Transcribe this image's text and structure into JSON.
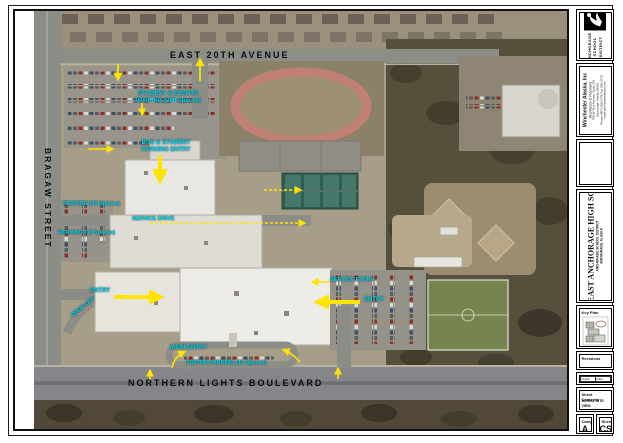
{
  "map": {
    "streets": {
      "east_20th": "EAST 20TH AVENUE",
      "bragaw": "BRAGAW STREET",
      "northern_lights": "NORTHERN LIGHTS BOULEVARD"
    },
    "labels": {
      "student_parking_1": "STUDENT & EVENTS",
      "student_parking_2": "PARKING (288 Spaces)",
      "bus_entry_1": "BUS & STUDENT",
      "bus_entry_2": "PARKING ENTRY",
      "parking_30": "PARKING (30 Spaces)",
      "service_drive": "SERVICE DRIVE",
      "parking_40": "PARKING (40 Spaces)",
      "drop_off": "DROP-OFF",
      "entry_west": "ENTRY",
      "service_entry": "SERVICE ENTRY",
      "entry_east": "ENTRY",
      "main_entry": "MAIN ENTRY",
      "visitor_parking": "VISITOR PARKING (19 Spaces)"
    },
    "colors": {
      "annotation": "#00e4ee",
      "arrow": "#ffe400",
      "street_text": "#0b0b0b"
    }
  },
  "titleblock": {
    "district": {
      "line1": "ANCHORAGE",
      "line2": "SCHOOL",
      "line3": "DISTRICT"
    },
    "firm": {
      "name": "Winchester Alaska, Inc",
      "tagline": "Architects & Planners",
      "addr1": "700 W 41st Avenue, Suite 201",
      "addr2": "Anchorage, Alaska 99503",
      "addr3": "Phone (907) 258-6778  Fax 258-6779",
      "addr4": "www.winchesteralaska.com"
    },
    "project": {
      "title": "EAST ANCHORAGE HIGH SCHOOL",
      "sub1": "ANCHORAGE SCHOOL DISTRICT",
      "sub2": "ANCHORAGE, ALASKA"
    },
    "key_plan_label": "Key Plan",
    "revisions_label": "Revisions",
    "info": {
      "r1c1": "Drawn",
      "r1c2": "Date",
      "r2c1": "Checked",
      "r2c2": "Job No.",
      "r3c1": "Scale",
      "r3c2": "File"
    },
    "contents": {
      "label": "Sheet Contents",
      "line1": "AERIAL SITE VIEW",
      "line2": "SITE PLAN"
    },
    "category": {
      "label": "Category",
      "value": "A"
    },
    "sheet": {
      "label": "Sheet",
      "value": "CS"
    }
  }
}
